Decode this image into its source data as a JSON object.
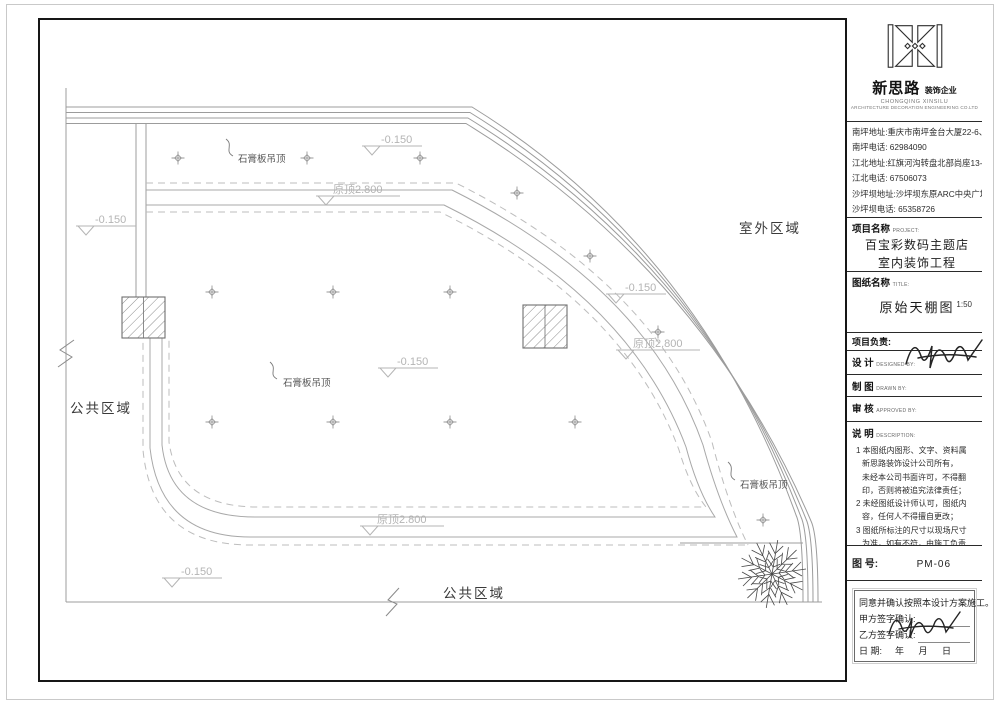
{
  "company": {
    "name_cn": "新思路",
    "name_suffix": "装饰企业",
    "name_en1": "CHONGQING XINSILU",
    "name_en2": "ARCHITECTURE DECORATION ENGINEERING CO.LTD"
  },
  "contacts": {
    "lines": [
      "南坪地址:重庆市南坪金台大厦22-6、7、9、10",
      "南坪电话: 62984090",
      "江北地址:红旗河沟转盘北部尚座13-7、8、9",
      "江北电话: 67506073",
      "沙坪坝地址:沙坪坝东原ARC中央广场1-10-3",
      "沙坪坝电话: 65358726"
    ]
  },
  "project": {
    "label": "项目名称",
    "label_en": "PROJECT:",
    "line1": "百宝彩数码主题店",
    "line2": "室内装饰工程"
  },
  "sheet": {
    "label": "图纸名称",
    "label_en": "TITLE:",
    "title": "原始天棚图",
    "scale": "1:50"
  },
  "roles": {
    "lead": "项目负责:",
    "design": "设  计",
    "design_en": "DESIGNED BY:",
    "draw": "制  图",
    "draw_en": "DRAWN BY:",
    "check": "审  核",
    "check_en": "APPROVED BY:"
  },
  "notes": {
    "label": "说  明",
    "label_en": "DESCRIPTION:",
    "lines": [
      "1 本图纸内图形、文字、资料属",
      "新思路装饰设计公司所有，",
      "未经本公司书面许可，不得翻",
      "印，否则将被追究法律责任；",
      "2 未经图纸设计师认可，图纸内",
      "容，任何人不得擅自更改；",
      "3 图纸所标注的尺寸以现场尺寸",
      "为准，如有不符，由施工负责",
      "人会同设计师加以调整。"
    ]
  },
  "sheet_no": {
    "label": "图 号:",
    "value": "PM-06"
  },
  "confirm": {
    "statement": "同意并确认按照本设计方案施工。",
    "party_a": "甲方签字确认:",
    "party_b": "乙方签字确认:",
    "date_label": "日      期:",
    "date_value": "年   月   日"
  },
  "drawing": {
    "labels": {
      "area_outdoor": "室外区域",
      "area_public": "公共区域",
      "gypsum_ceiling": "石膏板吊顶",
      "original_ceiling": "原顶2.800",
      "floor_level": "-0.150"
    },
    "colors": {
      "wall_line": "#9c9c9c",
      "ceiling_dashed": "#bdbdbd",
      "marker_text": "#b4b4b4",
      "frame": "#161616"
    }
  }
}
